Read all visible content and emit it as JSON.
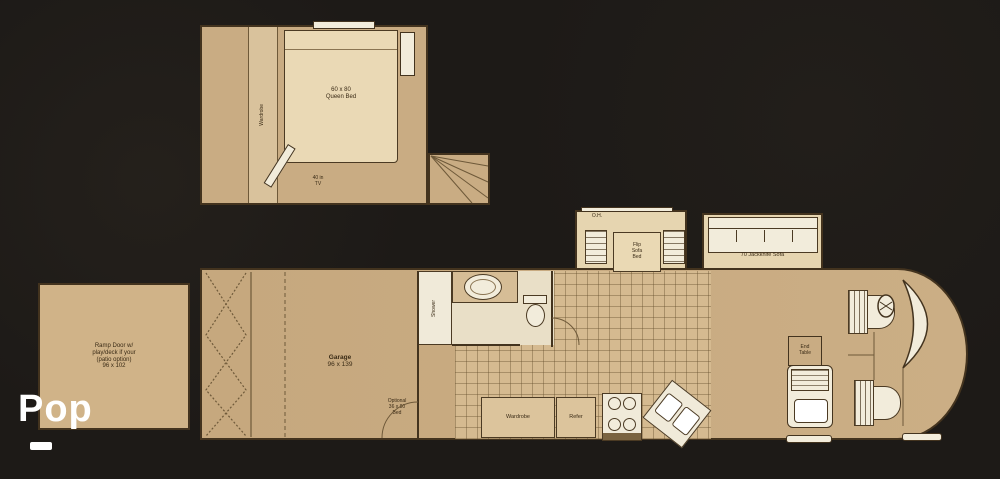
{
  "colors": {
    "background": "#1d1a17",
    "body_tan": "#c9ac83",
    "slide_tan": "#e6d5b0",
    "fixture_white": "#f2ecdb",
    "outline_brown": "#43331e",
    "watermark_white": "#ffffff"
  },
  "watermark": {
    "title": "Pop"
  },
  "upper_plan": {
    "wardrobe_label": "Wardrobe",
    "bed_label_line1": "60 x 80",
    "bed_label_line2": "Queen Bed",
    "tv_label_line1": "40 in",
    "tv_label_line2": "TV"
  },
  "lower_plan": {
    "patio_line1": "Ramp Door w/",
    "patio_line2": "play/deck if your",
    "patio_line3": "(patio option)",
    "patio_line4": "96 x 102",
    "garage_line1": "Garage",
    "garage_line2": "96 x 139",
    "optional_line1": "Optional",
    "optional_line2": "36 x 80",
    "optional_line3": "Bed",
    "shower_label": "Shower",
    "oh_label": "O.H.",
    "dinette_line1": "Flip",
    "dinette_line2": "Sofa",
    "dinette_line3": "Bed",
    "sofa_label": "70 Jackknife Sofa",
    "wardrobe_label": "Wardrobe",
    "refer_label": "Refer",
    "end_table_line1": "End",
    "end_table_line2": "Table"
  }
}
